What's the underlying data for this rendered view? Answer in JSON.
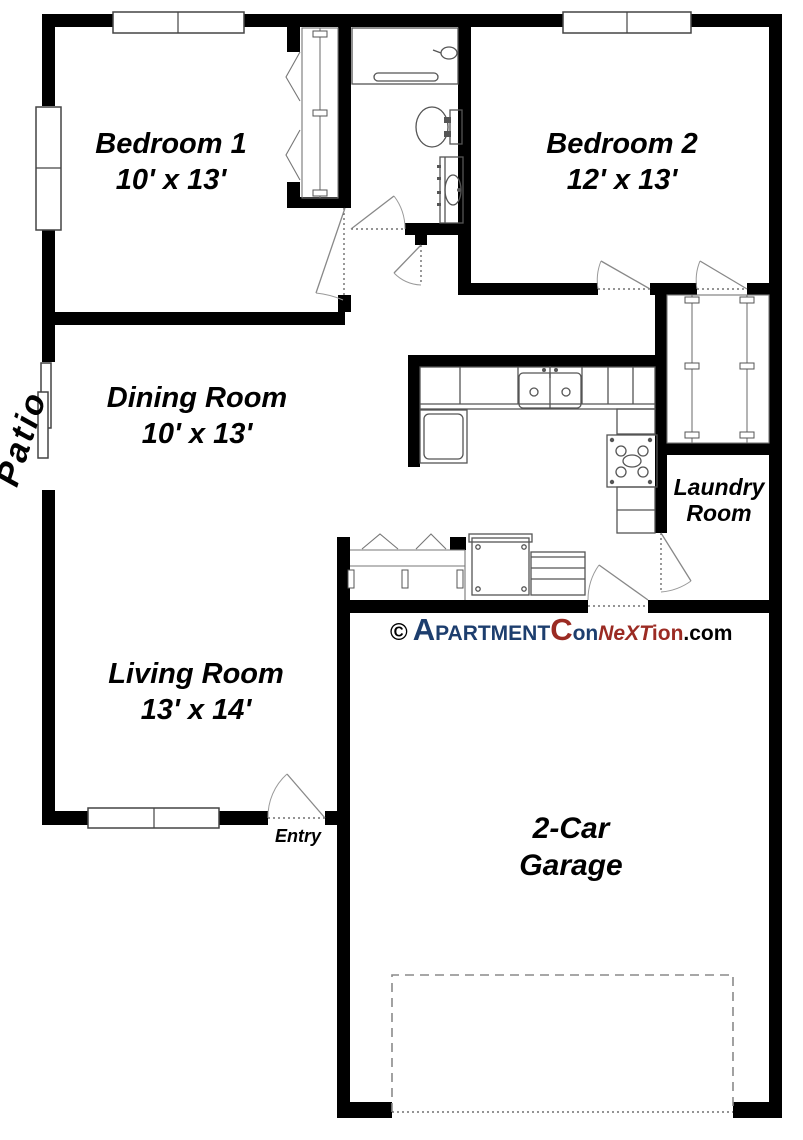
{
  "title": "Apartment floor plan",
  "colors": {
    "wall": "#000000",
    "fixture_line": "#555555",
    "door_line": "#888888",
    "watermark_navy": "#1d3e6e",
    "watermark_maroon": "#9b2b23",
    "background": "#ffffff",
    "text": "#000000"
  },
  "rooms": {
    "bedroom1": {
      "name": "Bedroom 1",
      "dims": "10' x 13'"
    },
    "bedroom2": {
      "name": "Bedroom 2",
      "dims": "12' x 13'"
    },
    "dining": {
      "name": "Dining Room",
      "dims": "10' x 13'"
    },
    "living": {
      "name": "Living Room",
      "dims": "13' x 14'"
    },
    "laundry": {
      "line1": "Laundry",
      "line2": "Room"
    },
    "garage": {
      "line1": "2-Car",
      "line2": "Garage"
    }
  },
  "labels": {
    "patio": "Patio",
    "entry": "Entry"
  },
  "watermark": {
    "copyright": "©",
    "seg_a": "A",
    "seg_partment": "PARTMENT",
    "seg_c": "C",
    "seg_on": "on",
    "seg_next": "NeXT",
    "seg_ion": "ion",
    "seg_com": ".com"
  },
  "icons": {
    "bathtub": "bathtub-icon",
    "shower_head": "shower-head-icon",
    "toilet": "toilet-icon",
    "vanity_sink": "vanity-sink-icon",
    "kitchen_sink": "kitchen-sink-icon",
    "stove": "stove-icon",
    "refrigerator": "refrigerator-icon",
    "washer": "washer-icon",
    "dryer": "dryer-icon",
    "window": "window-icon",
    "sliding_patio_door": "sliding-door-icon",
    "bifold_door": "bifold-door-icon",
    "door_swing": "door-swing-icon",
    "closet_rod": "closet-rod-icon",
    "garage_door": "garage-door-icon"
  }
}
